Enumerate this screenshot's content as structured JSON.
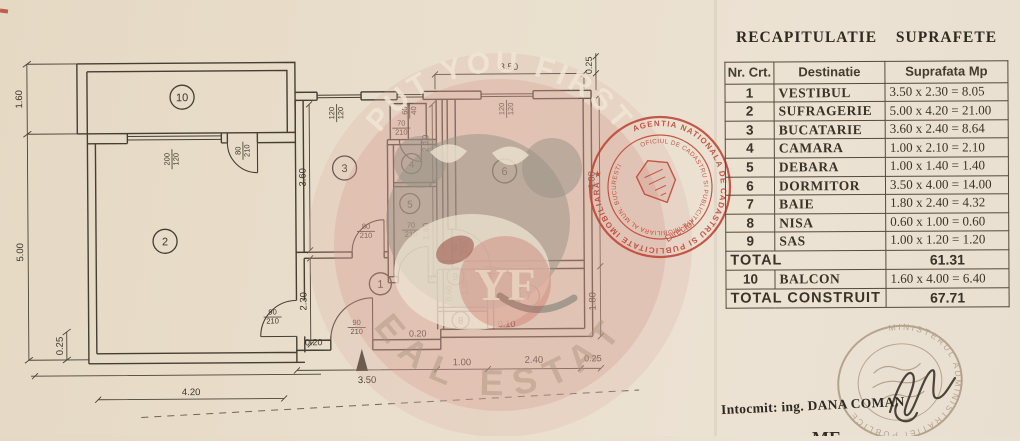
{
  "document": {
    "title": "RECAPITULATIE  SUPRAFETE",
    "prepared_by": "Intocmit:  ing. DANA COMAN",
    "bottom_partial_text": "ME"
  },
  "table": {
    "headers": [
      "Nr. Crt.",
      "Destinatie",
      "Suprafata  Mp"
    ],
    "rows": [
      {
        "nr": "1",
        "name": "VESTIBUL",
        "sup": "3.50 x 2.30  = 8.05"
      },
      {
        "nr": "2",
        "name": "SUFRAGERIE",
        "sup": "5.00 x 4.20 = 21.00"
      },
      {
        "nr": "3",
        "name": "BUCATARIE",
        "sup": "3.60 x 2.40 = 8.64"
      },
      {
        "nr": "4",
        "name": "CAMARA",
        "sup": "1.00 x 2.10 = 2.10"
      },
      {
        "nr": "5",
        "name": "DEBARA",
        "sup": "1.00 x 1.40 = 1.40"
      },
      {
        "nr": "6",
        "name": "DORMITOR",
        "sup": "3.50 x 4.00 = 14.00"
      },
      {
        "nr": "7",
        "name": "BAIE",
        "sup": "1.80 x 2.40 = 4.32"
      },
      {
        "nr": "8",
        "name": "NISA",
        "sup": "0.60 x 1.00 = 0.60"
      },
      {
        "nr": "9",
        "name": "SAS",
        "sup": "1.00 x 1.20 = 1.20"
      },
      {
        "label": "TOTAL",
        "sup": "61.31",
        "span": true
      },
      {
        "nr": "10",
        "name": "BALCON",
        "sup": "1.60 x 4.00 = 6.40"
      },
      {
        "label": "TOTAL CONSTRUIT",
        "sup": "67.71",
        "span": true
      }
    ]
  },
  "plan": {
    "rooms": {
      "r1": "1",
      "r2": "2",
      "r3": "3",
      "r4": "4",
      "r5": "5",
      "r6": "6",
      "r7": "7",
      "r8": "8",
      "r9": "9",
      "r10": "10"
    },
    "dims": {
      "balcony_h": "1.60",
      "room2_h": "5.00",
      "wall_bl": "0.25",
      "room2_w": "4.20",
      "baseline_020a": "0.20",
      "bottom_350": "3.50",
      "bottom_100": "1.00",
      "bottom_240": "2.40",
      "bottom_025": "0.25",
      "bottom_020b": "0.20",
      "bottom_010": "0.10",
      "top_350": "3.50",
      "top_025": "0.25",
      "right_400": "4.00",
      "right_180": "1.80",
      "room3_h": "3.60",
      "room1_h": "2.30",
      "mid_210": "2.10",
      "mid_140": "1.40",
      "sas_w": "0.60",
      "sas_h": "1.20"
    },
    "openings": {
      "w200": {
        "w": "200",
        "h": "120"
      },
      "d80a": {
        "w": "80",
        "h": "210"
      },
      "w120a": {
        "w": "120",
        "h": "120"
      },
      "w60": {
        "w": "60",
        "h": "40"
      },
      "d70a": {
        "w": "70",
        "h": "210"
      },
      "w120b": {
        "w": "120",
        "h": "120"
      },
      "d80b": {
        "w": "80",
        "h": "210"
      },
      "d70b": {
        "w": "70",
        "h": "210"
      },
      "d90a": {
        "w": "90",
        "h": "210"
      },
      "d90b": {
        "w": "90",
        "h": "210"
      },
      "d90c": {
        "w": "90",
        "h": "210"
      },
      "d70c": {
        "w": "70",
        "h": "210"
      }
    }
  },
  "watermark": {
    "arc_top": "PUT YOU FIRST",
    "monogram": "YF",
    "arc_bottom": "REAL ESTATE"
  },
  "stamps": {
    "cadastru": {
      "ring1": "AGENTIA NATIONALA DE CADASTRU SI PUBLICITATE IMOBILIARA ★",
      "ring2": "OFICIUL DE CADASTRU SI PUBLICITATE IMOBILIARA AL MUN. BUCURESTI",
      "role": "Director"
    },
    "minister": {
      "ring": "MINISTERUL ADMINISTRATIEI PUBLICE"
    }
  },
  "colors": {
    "paper": "#eadfcd",
    "ink": "#453e33",
    "stamp_red": "#bf4434",
    "stamp_gray": "#8a7258",
    "watermark_pink": "#d798 8c"
  }
}
